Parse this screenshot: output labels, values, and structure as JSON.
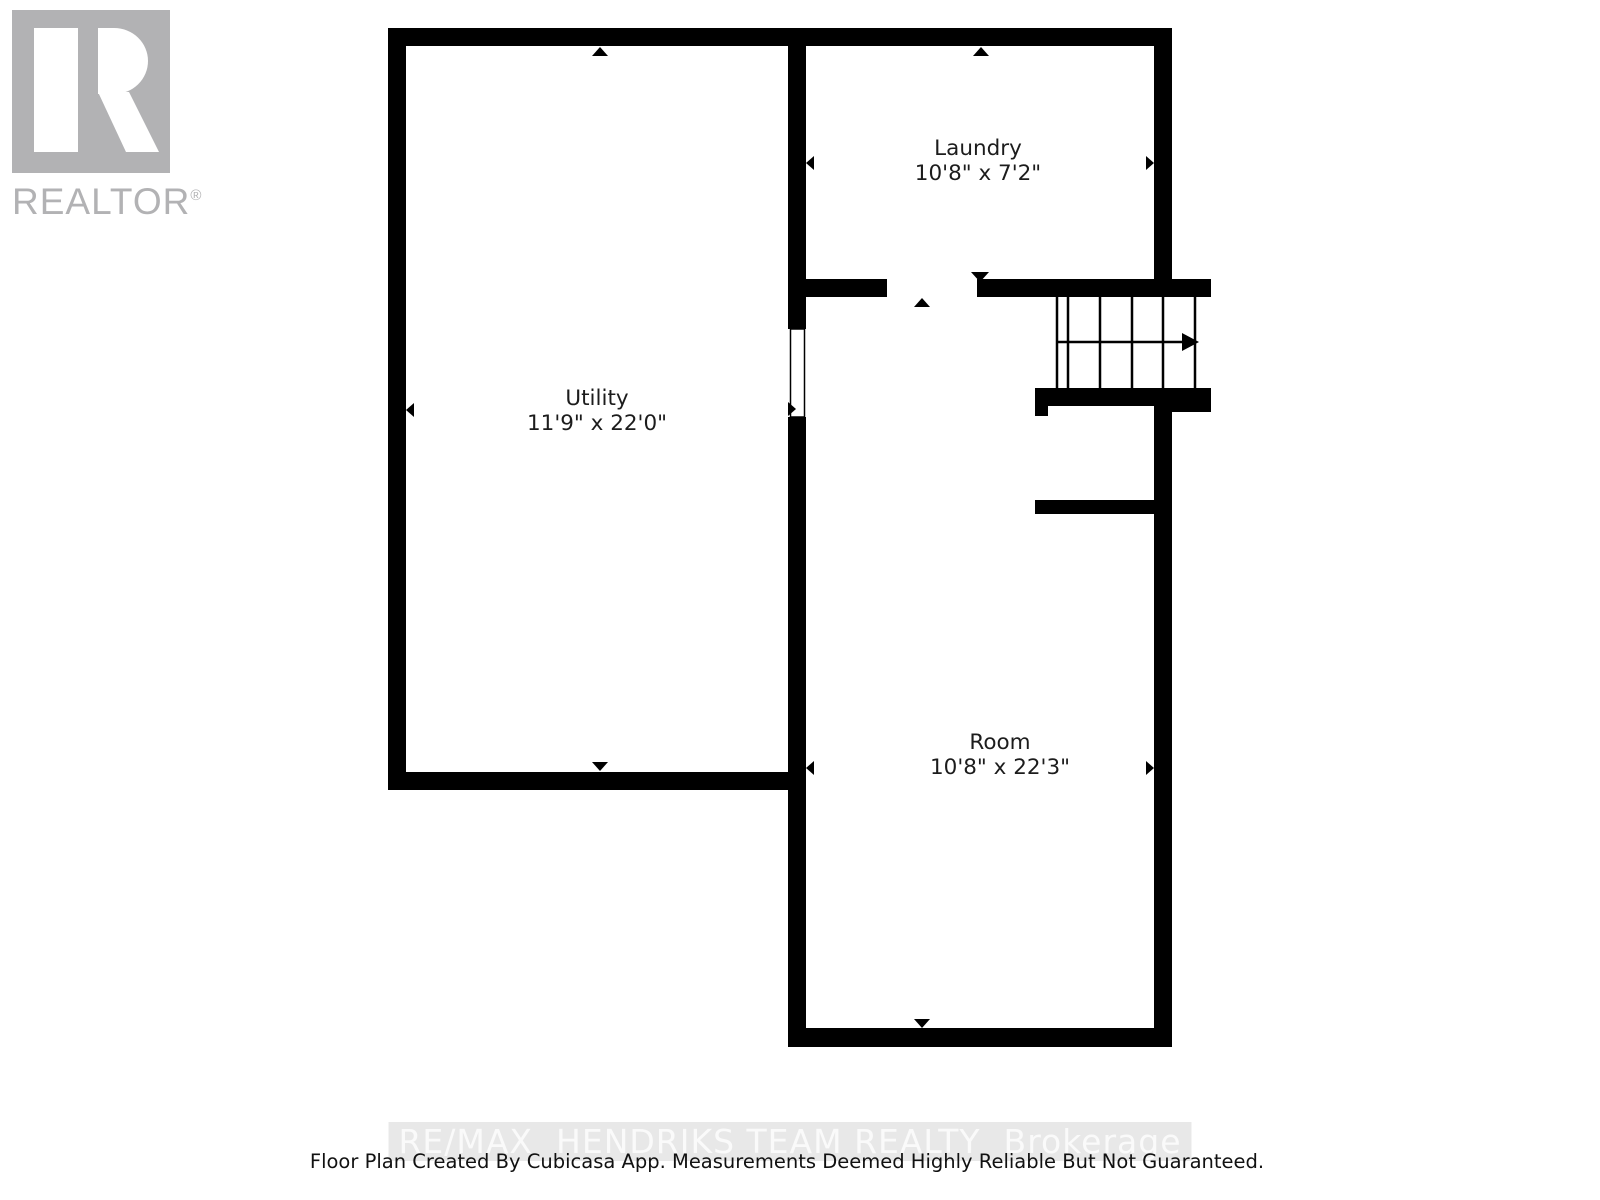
{
  "branding": {
    "logo_text": "REALTOR",
    "registered_mark": "®"
  },
  "floor_plan": {
    "rooms": [
      {
        "name": "Utility",
        "dimensions": "11'9\" x 22'0\""
      },
      {
        "name": "Laundry",
        "dimensions": "10'8\" x 7'2\""
      },
      {
        "name": "Room",
        "dimensions": "10'8\" x 22'3\""
      }
    ]
  },
  "watermark": {
    "text": "RE/MAX  HENDRIKS TEAM REALTY  Brokerage"
  },
  "footer": {
    "text": "Floor Plan Created By Cubicasa App. Measurements Deemed Highly Reliable But Not Guaranteed."
  },
  "colors": {
    "background": "#ffffff",
    "wall": "#000000",
    "logo-gray": "#b2b2b4",
    "label-text": "#1c1c1c",
    "watermark-text": "#fafafa",
    "watermark-band": "#e8e8e8",
    "footer-text": "#111111"
  }
}
